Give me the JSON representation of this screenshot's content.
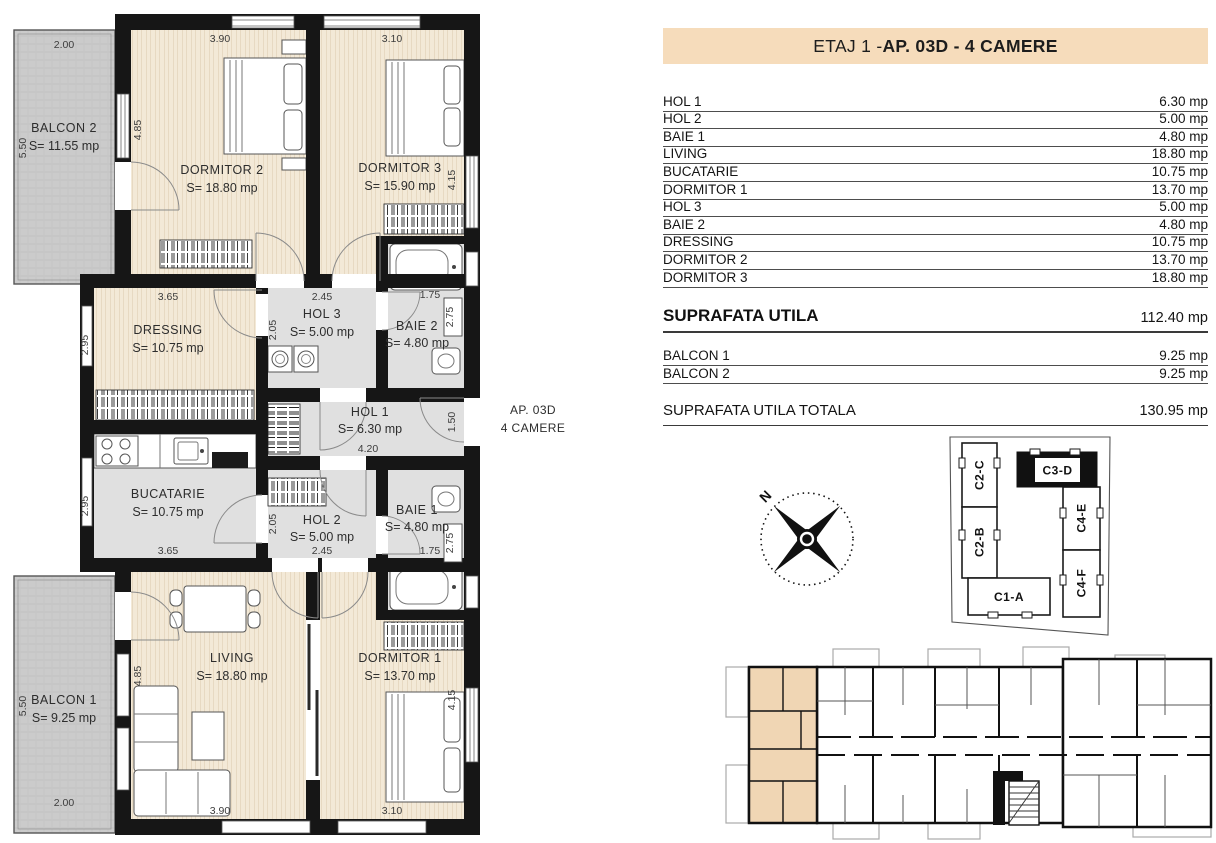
{
  "title_panel": {
    "floor_prefix": "ETAJ 1 - ",
    "apartment": "AP. 03D - 4 CAMERE"
  },
  "areas_table": {
    "rows": [
      {
        "label": "HOL 1",
        "value": "6.30 mp"
      },
      {
        "label": "HOL 2",
        "value": "5.00 mp"
      },
      {
        "label": "BAIE 1",
        "value": "4.80 mp"
      },
      {
        "label": "LIVING",
        "value": "18.80 mp"
      },
      {
        "label": "BUCATARIE",
        "value": "10.75 mp"
      },
      {
        "label": "DORMITOR 1",
        "value": "13.70 mp"
      },
      {
        "label": "HOL 3",
        "value": "5.00 mp"
      },
      {
        "label": "BAIE 2",
        "value": "4.80 mp"
      },
      {
        "label": "DRESSING",
        "value": "10.75 mp"
      },
      {
        "label": "DORMITOR 2",
        "value": "13.70 mp"
      },
      {
        "label": "DORMITOR 3",
        "value": "18.80 mp"
      }
    ]
  },
  "summary": {
    "useful_area": {
      "label": "SUPRAFATA UTILA",
      "value": "112.40 mp"
    },
    "balconies": [
      {
        "label": "BALCON 1",
        "value": "9.25 mp"
      },
      {
        "label": "BALCON 2",
        "value": "9.25 mp"
      }
    ],
    "total": {
      "label": "SUPRAFATA UTILA TOTALA",
      "value": "130.95 mp"
    }
  },
  "floor_plan": {
    "annotation": {
      "line1": "AP. 03D",
      "line2": "4 CAMERE"
    },
    "rooms": [
      {
        "name": "BALCON 2",
        "area": "S= 11.55 mp",
        "w": "2.00",
        "h": "5.50"
      },
      {
        "name": "DORMITOR 2",
        "area": "S= 18.80 mp",
        "w": "3.90",
        "h": "4.85"
      },
      {
        "name": "DORMITOR 3",
        "area": "S= 15.90 mp",
        "w": "3.10",
        "h": "4.15"
      },
      {
        "name": "DRESSING",
        "area": "S= 10.75 mp",
        "w": "3.65",
        "h": "2.95"
      },
      {
        "name": "HOL 3",
        "area": "S= 5.00 mp",
        "w": "2.45",
        "h": "2.05"
      },
      {
        "name": "BAIE 2",
        "area": "S= 4.80 mp",
        "w": "1.75",
        "h": "2.75"
      },
      {
        "name": "HOL 1",
        "area": "S= 6.30 mp",
        "w": "4.20",
        "h": "1.50"
      },
      {
        "name": "BUCATARIE",
        "area": "S= 10.75 mp",
        "w": "3.65",
        "h": "2.95"
      },
      {
        "name": "HOL 2",
        "area": "S= 5.00 mp",
        "w": "2.45",
        "h": "2.05"
      },
      {
        "name": "BAIE 1",
        "area": "S= 4.80 mp",
        "w": "1.75",
        "h": "2.75"
      },
      {
        "name": "LIVING",
        "area": "S= 18.80 mp",
        "w": "3.90",
        "h": "4.85"
      },
      {
        "name": "DORMITOR 1",
        "area": "S= 13.70 mp",
        "w": "3.10",
        "h": "4.15"
      },
      {
        "name": "BALCON 1",
        "area": "S= 9.25 mp",
        "w": "2.00",
        "h": "5.50"
      }
    ]
  },
  "site_plan": {
    "units": [
      {
        "label": "C2-C",
        "highlighted": false
      },
      {
        "label": "C3-D",
        "highlighted": true
      },
      {
        "label": "C2-B",
        "highlighted": false
      },
      {
        "label": "C4-E",
        "highlighted": false
      },
      {
        "label": "C4-F",
        "highlighted": false
      },
      {
        "label": "C1-A",
        "highlighted": false
      }
    ]
  },
  "compass": {
    "north": "N"
  },
  "colors": {
    "header_bg": "#f6dcbb",
    "highlight": "#f0d6b4",
    "wood": "#f3e9d7",
    "room_gray": "#e0e0e0",
    "balcony_gray": "#cbcbcb",
    "wall": "#161616"
  }
}
